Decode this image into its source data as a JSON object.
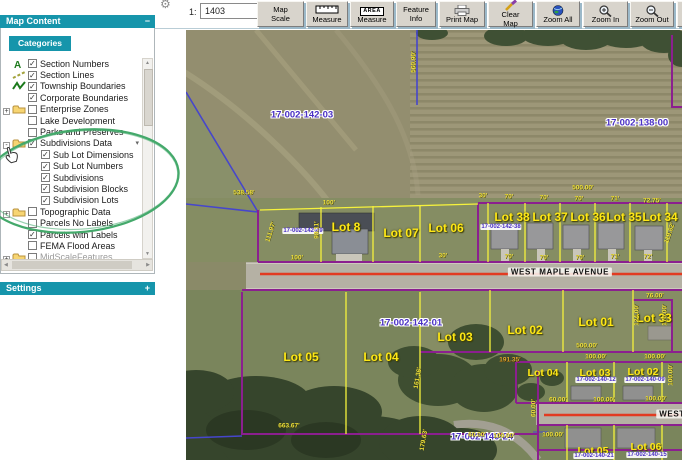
{
  "toolbar": {
    "scale_prefix": "1:",
    "scale_value": "1403",
    "area_icon_text": "AREA",
    "buttons": [
      {
        "label": "Map Scale"
      },
      {
        "label": "Measure"
      },
      {
        "label": "Measure"
      },
      {
        "label": "Feature Info"
      },
      {
        "label": "Print Map"
      },
      {
        "label": "Clear Map"
      },
      {
        "label": "Zoom All"
      },
      {
        "label": "Zoom In"
      },
      {
        "label": "Zoom Out"
      }
    ]
  },
  "sidebar": {
    "header": {
      "title": "Map Content",
      "collapse": "−"
    },
    "tab": "Categories",
    "dropdown_glyph": "▾",
    "scroll": {
      "up": "▲",
      "down": "▼",
      "left": "◀",
      "right": "▶"
    },
    "icon_glyphs": {
      "section_numbers": "A"
    },
    "settings": {
      "title": "Settings",
      "expand": "+"
    },
    "tree": [
      {
        "label": "Section Numbers",
        "checked": true,
        "icon": "section-numbers",
        "level": 0
      },
      {
        "label": "Section Lines",
        "checked": true,
        "icon": "section-lines",
        "level": 0
      },
      {
        "label": "Township Boundaries",
        "checked": true,
        "icon": "township",
        "level": 0
      },
      {
        "label": "Corporate Boundaries",
        "checked": true,
        "icon": "corporate",
        "level": 0
      },
      {
        "label": "Enterprise Zones",
        "checked": false,
        "icon": "folder",
        "expander": "+",
        "level": 0
      },
      {
        "label": "Lake Development",
        "checked": false,
        "icon": "lake",
        "level": 0
      },
      {
        "label": "Parks and Preserves",
        "checked": false,
        "icon": "none",
        "level": 0
      },
      {
        "label": "Subdivisions Data",
        "checked": true,
        "icon": "folder",
        "expander": "-",
        "level": 0,
        "dropdown": true
      },
      {
        "label": "Sub Lot Dimensions",
        "checked": true,
        "icon": "none",
        "level": 1
      },
      {
        "label": "Sub Lot Numbers",
        "checked": true,
        "icon": "none",
        "level": 1
      },
      {
        "label": "Subdivisions",
        "checked": true,
        "icon": "subdivisions",
        "level": 1
      },
      {
        "label": "Subdivision Blocks",
        "checked": true,
        "icon": "blocks",
        "level": 1
      },
      {
        "label": "Subdivision Lots",
        "checked": true,
        "icon": "lots",
        "level": 1
      },
      {
        "label": "Topographic Data",
        "checked": false,
        "icon": "folder",
        "expander": "+",
        "level": 0
      },
      {
        "label": "Parcels No Labels",
        "checked": false,
        "icon": "parcel",
        "level": 0
      },
      {
        "label": "Parcels with Labels",
        "checked": true,
        "icon": "parcel",
        "level": 0
      },
      {
        "label": "FEMA Flood Areas",
        "checked": false,
        "icon": "fema",
        "level": 0
      },
      {
        "label": "MidScaleFeatures",
        "checked": false,
        "icon": "folder",
        "expander": "+",
        "level": 0,
        "partial": true
      }
    ]
  },
  "map": {
    "labels": [
      {
        "t": "Lot 8",
        "x": 160,
        "y": 197,
        "c": "lot-lg"
      },
      {
        "t": "Lot 07",
        "x": 215,
        "y": 203,
        "c": "lot-lg"
      },
      {
        "t": "Lot 06",
        "x": 260,
        "y": 198,
        "c": "lot-lg"
      },
      {
        "t": "Lot 38",
        "x": 326,
        "y": 187,
        "c": "lot-lg"
      },
      {
        "t": "Lot 37",
        "x": 364,
        "y": 187,
        "c": "lot-lg"
      },
      {
        "t": "Lot 36",
        "x": 402,
        "y": 187,
        "c": "lot-lg"
      },
      {
        "t": "Lot 35",
        "x": 438,
        "y": 187,
        "c": "lot-lg"
      },
      {
        "t": "Lot 34",
        "x": 474,
        "y": 187,
        "c": "lot-lg"
      },
      {
        "t": "Lot 05",
        "x": 115,
        "y": 327,
        "c": "lot-lg"
      },
      {
        "t": "Lot 04",
        "x": 195,
        "y": 327,
        "c": "lot-lg"
      },
      {
        "t": "Lot 03",
        "x": 269,
        "y": 307,
        "c": "lot-lg"
      },
      {
        "t": "Lot 02",
        "x": 339,
        "y": 300,
        "c": "lot-lg"
      },
      {
        "t": "Lot 01",
        "x": 410,
        "y": 292,
        "c": "lot-lg"
      },
      {
        "t": "Lot 33",
        "x": 468,
        "y": 288,
        "c": "lot-lg"
      },
      {
        "t": "Lot 04",
        "x": 357,
        "y": 343,
        "c": "lot-md"
      },
      {
        "t": "Lot 03",
        "x": 409,
        "y": 343,
        "c": "lot-md"
      },
      {
        "t": "Lot 02",
        "x": 457,
        "y": 342,
        "c": "lot-md"
      },
      {
        "t": "Lot 05",
        "x": 407,
        "y": 421,
        "c": "lot-md"
      },
      {
        "t": "Lot 06",
        "x": 460,
        "y": 417,
        "c": "lot-md"
      },
      {
        "t": "17-002-142-03",
        "x": 116,
        "y": 85,
        "c": "pid"
      },
      {
        "t": "17-002-138-00",
        "x": 451,
        "y": 93,
        "c": "pid"
      },
      {
        "t": "17-002-142-49",
        "x": 117,
        "y": 201,
        "c": "pid-sm"
      },
      {
        "t": "17-002-142-38",
        "x": 315,
        "y": 197,
        "c": "pid-sm"
      },
      {
        "t": "17-002-142-01",
        "x": 225,
        "y": 293,
        "c": "pid"
      },
      {
        "t": "17-002-140-24",
        "x": 296,
        "y": 407,
        "c": "pid"
      },
      {
        "t": "17-002-140-12",
        "x": 410,
        "y": 350,
        "c": "pid-sm"
      },
      {
        "t": "17-002-140-09",
        "x": 459,
        "y": 350,
        "c": "pid-sm"
      },
      {
        "t": "17-002-140-21",
        "x": 408,
        "y": 426,
        "c": "pid-sm"
      },
      {
        "t": "17-002-140-15",
        "x": 461,
        "y": 425,
        "c": "pid-sm"
      },
      {
        "t": "538.58'",
        "x": 58,
        "y": 163,
        "c": "dim"
      },
      {
        "t": "560.90'",
        "x": 228,
        "y": 32,
        "c": "dim",
        "r": -90
      },
      {
        "t": "100'",
        "x": 143,
        "y": 173,
        "c": "dim"
      },
      {
        "t": "100'",
        "x": 111,
        "y": 228,
        "c": "dim"
      },
      {
        "t": "111.97'",
        "x": 85,
        "y": 202,
        "c": "dim",
        "r": -72
      },
      {
        "t": "98.11'",
        "x": 131,
        "y": 200,
        "c": "dim",
        "r": -90
      },
      {
        "t": "500.00'",
        "x": 397,
        "y": 158,
        "c": "dim"
      },
      {
        "t": "30'",
        "x": 297,
        "y": 166,
        "c": "dim"
      },
      {
        "t": "70'",
        "x": 323,
        "y": 167,
        "c": "dim"
      },
      {
        "t": "70'",
        "x": 358,
        "y": 168,
        "c": "dim"
      },
      {
        "t": "70'",
        "x": 393,
        "y": 169,
        "c": "dim"
      },
      {
        "t": "71'",
        "x": 429,
        "y": 169,
        "c": "dim"
      },
      {
        "t": "72.75'",
        "x": 466,
        "y": 171,
        "c": "dim"
      },
      {
        "t": "30'",
        "x": 257,
        "y": 226,
        "c": "dim"
      },
      {
        "t": "70'",
        "x": 323,
        "y": 227,
        "c": "dim"
      },
      {
        "t": "70'",
        "x": 358,
        "y": 228,
        "c": "dim"
      },
      {
        "t": "70'",
        "x": 394,
        "y": 228,
        "c": "dim"
      },
      {
        "t": "71'",
        "x": 429,
        "y": 227,
        "c": "dim"
      },
      {
        "t": "72'",
        "x": 462,
        "y": 227,
        "c": "dim"
      },
      {
        "t": "119.82'",
        "x": 484,
        "y": 203,
        "c": "dim",
        "r": -72
      },
      {
        "t": "76.00'",
        "x": 469,
        "y": 266,
        "c": "dim"
      },
      {
        "t": "124.00'",
        "x": 451,
        "y": 285,
        "c": "dim",
        "r": -90
      },
      {
        "t": "170.00'",
        "x": 479,
        "y": 285,
        "c": "dim",
        "r": -90
      },
      {
        "t": "191.35'",
        "x": 324,
        "y": 330,
        "c": "dim-o"
      },
      {
        "t": "500.00'",
        "x": 401,
        "y": 316,
        "c": "dim"
      },
      {
        "t": "100.00'",
        "x": 410,
        "y": 327,
        "c": "dim"
      },
      {
        "t": "100.00'",
        "x": 469,
        "y": 327,
        "c": "dim"
      },
      {
        "t": "100.00'",
        "x": 485,
        "y": 345,
        "c": "dim",
        "r": -90
      },
      {
        "t": "663.67'",
        "x": 103,
        "y": 396,
        "c": "dim"
      },
      {
        "t": "161.36'",
        "x": 232,
        "y": 348,
        "c": "dim",
        "r": -80
      },
      {
        "t": "179.63'",
        "x": 238,
        "y": 410,
        "c": "dim",
        "r": -80
      },
      {
        "t": "60.00'",
        "x": 372,
        "y": 370,
        "c": "dim"
      },
      {
        "t": "100.00'",
        "x": 418,
        "y": 370,
        "c": "dim"
      },
      {
        "t": "100.00'",
        "x": 470,
        "y": 369,
        "c": "dim"
      },
      {
        "t": "60.00'",
        "x": 348,
        "y": 378,
        "c": "dim",
        "r": -90
      },
      {
        "t": "60.00'",
        "x": 291,
        "y": 405,
        "c": "dim"
      },
      {
        "t": "100.00'",
        "x": 318,
        "y": 406,
        "c": "dim"
      },
      {
        "t": "100.00'",
        "x": 367,
        "y": 405,
        "c": "dim"
      },
      {
        "t": "WEST MAPLE AVENUE",
        "x": 374,
        "y": 242,
        "c": "street"
      },
      {
        "t": "WEST",
        "x": 486,
        "y": 384,
        "c": "street"
      }
    ]
  },
  "annotation": {
    "color": "#44a96b"
  }
}
